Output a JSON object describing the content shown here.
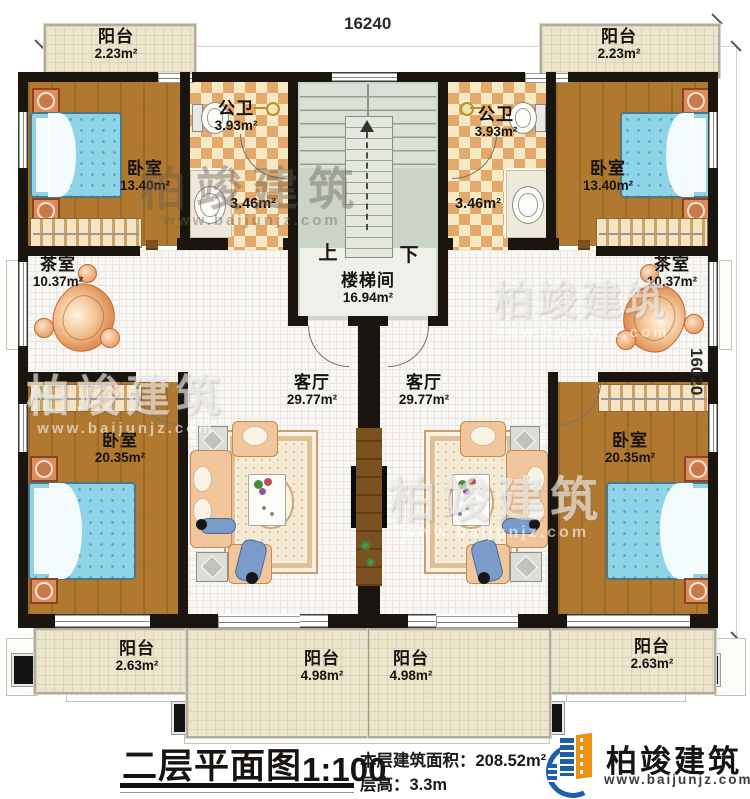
{
  "dimensions": {
    "top": "16240",
    "right": "16020"
  },
  "rooms": {
    "balcony_tl": {
      "name": "阳台",
      "area": "2.23m²"
    },
    "balcony_tr": {
      "name": "阳台",
      "area": "2.23m²"
    },
    "bedroom_tl": {
      "name": "卧室",
      "area": "13.40m²"
    },
    "bedroom_tr": {
      "name": "卧室",
      "area": "13.40m²"
    },
    "bath_l": {
      "name": "公卫",
      "area": "3.93m²"
    },
    "bath_r": {
      "name": "公卫",
      "area": "3.93m²"
    },
    "wash_l": {
      "area": "3.46m²"
    },
    "wash_r": {
      "area": "3.46m²"
    },
    "tea_l": {
      "name": "茶室",
      "area": "10.37m²"
    },
    "tea_r": {
      "name": "茶室",
      "area": "10.37m²"
    },
    "stairwell": {
      "name": "楼梯间",
      "area": "16.94m²",
      "up": "上",
      "down": "下"
    },
    "living_l": {
      "name": "客厅",
      "area": "29.77m²"
    },
    "living_r": {
      "name": "客厅",
      "area": "29.77m²"
    },
    "bedroom_bl": {
      "name": "卧室",
      "area": "20.35m²"
    },
    "bedroom_br": {
      "name": "卧室",
      "area": "20.35m²"
    },
    "balcony_bl": {
      "name": "阳台",
      "area": "2.63m²"
    },
    "balcony_br": {
      "name": "阳台",
      "area": "2.63m²"
    },
    "balcony_bcl": {
      "name": "阳台",
      "area": "4.98m²"
    },
    "balcony_bcr": {
      "name": "阳台",
      "area": "4.98m²"
    }
  },
  "titleblock": {
    "plan_title": "二层平面图",
    "scale": "1:100",
    "area_label": "本层建筑面积：",
    "area_value": "208.52m²",
    "floor_height_label": "层高：",
    "floor_height_value": "3.3m"
  },
  "logo": {
    "company": "柏竣建筑",
    "website": "www.baijunjz.com"
  },
  "watermark": {
    "text": "柏竣建筑",
    "url": "www.baijunjz.com"
  },
  "colors": {
    "wall": "#1b1510",
    "wood_floor": "#b0792f",
    "checker_tile": "#e3a96a",
    "white_tile": "#f8f7f3",
    "balcony_tile": "#ece4cb",
    "stair_floor": "#ccd4c8",
    "bed_blue": "#8fd3e6",
    "logo_blue": "#1e5fa8",
    "logo_orange": "#f0900f"
  }
}
